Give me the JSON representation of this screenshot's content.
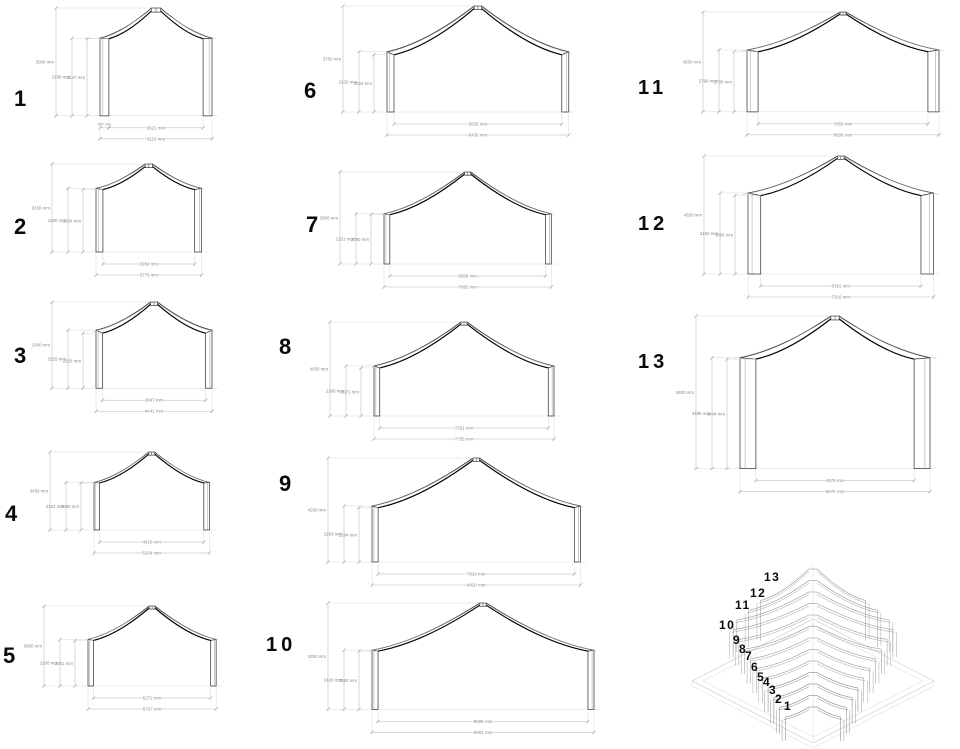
{
  "frames": [
    {
      "number": "1",
      "total_height_label": "3000 mm",
      "eave_height_outer_label": "2158 mm",
      "eave_height_inner_label": "2147 mm",
      "column_width_label": "247 mm",
      "inner_width_label": "2621 mm",
      "outer_width_label": "3116 mm",
      "dims_mm": {
        "total_height": 3000,
        "eave_outer": 2158,
        "eave_inner": 2147,
        "inner_width": 2621,
        "outer_width": 3116
      }
    },
    {
      "number": "2",
      "total_height_label": "3150 mm",
      "eave_height_outer_label": "2280 mm",
      "eave_height_inner_label": "2234 mm",
      "inner_width_label": "3284 mm",
      "outer_width_label": "3779 mm",
      "dims_mm": {
        "total_height": 3150,
        "eave_outer": 2280,
        "eave_inner": 2234,
        "inner_width": 3284,
        "outer_width": 3779
      }
    },
    {
      "number": "3",
      "total_height_label": "3300 mm",
      "eave_height_outer_label": "2225 mm",
      "eave_height_inner_label": "2105 mm",
      "inner_width_label": "3947 mm",
      "outer_width_label": "4441 mm",
      "dims_mm": {
        "total_height": 3300,
        "eave_outer": 2225,
        "eave_inner": 2105,
        "inner_width": 3947,
        "outer_width": 4441
      }
    },
    {
      "number": "4",
      "total_height_label": "3450 mm",
      "eave_height_outer_label": "2104 mm",
      "eave_height_inner_label": "2080 mm",
      "inner_width_label": "4610 mm",
      "outer_width_label": "5104 mm",
      "dims_mm": {
        "total_height": 3450,
        "eave_outer": 2104,
        "eave_inner": 2080,
        "inner_width": 4610,
        "outer_width": 5104
      }
    },
    {
      "number": "5",
      "total_height_label": "3600 mm",
      "eave_height_outer_label": "2100 mm",
      "eave_height_inner_label": "2051 mm",
      "inner_width_label": "5272 mm",
      "outer_width_label": "5767 mm",
      "dims_mm": {
        "total_height": 3600,
        "eave_outer": 2100,
        "eave_inner": 2051,
        "inner_width": 5272,
        "outer_width": 5767
      }
    },
    {
      "number": "6",
      "total_height_label": "3750 mm",
      "eave_height_outer_label": "2132 mm",
      "eave_height_inner_label": "2024 mm",
      "inner_width_label": "5935 mm",
      "outer_width_label": "6430 mm",
      "dims_mm": {
        "total_height": 3750,
        "eave_outer": 2132,
        "eave_inner": 2024,
        "inner_width": 5935,
        "outer_width": 6430
      }
    },
    {
      "number": "7",
      "total_height_label": "3900 mm",
      "eave_height_outer_label": "2131 mm",
      "eave_height_inner_label": "2090 mm",
      "inner_width_label": "6598 mm",
      "outer_width_label": "7092 mm",
      "dims_mm": {
        "total_height": 3900,
        "eave_outer": 2131,
        "eave_inner": 2090,
        "inner_width": 6598,
        "outer_width": 7092
      }
    },
    {
      "number": "8",
      "total_height_label": "4050 mm",
      "eave_height_outer_label": "2160 mm",
      "eave_height_inner_label": "2071 mm",
      "inner_width_label": "7261 mm",
      "outer_width_label": "7755 mm",
      "dims_mm": {
        "total_height": 4050,
        "eave_outer": 2160,
        "eave_inner": 2071,
        "inner_width": 7261,
        "outer_width": 7755
      }
    },
    {
      "number": "9",
      "total_height_label": "4200 mm",
      "eave_height_outer_label": "2263 mm",
      "eave_height_inner_label": "2194 mm",
      "inner_width_label": "7924 mm",
      "outer_width_label": "8420 mm",
      "dims_mm": {
        "total_height": 4200,
        "eave_outer": 2263,
        "eave_inner": 2194,
        "inner_width": 7924,
        "outer_width": 8420
      }
    },
    {
      "number": "10",
      "total_height_label": "4350 mm",
      "eave_height_outer_label": "2420 mm",
      "eave_height_inner_label": "2382 mm",
      "inner_width_label": "8586 mm",
      "outer_width_label": "9081 mm",
      "dims_mm": {
        "total_height": 4350,
        "eave_outer": 2420,
        "eave_inner": 2382,
        "inner_width": 8586,
        "outer_width": 9081
      }
    },
    {
      "number": "11",
      "total_height_label": "4500 mm",
      "eave_height_outer_label": "2790 mm",
      "eave_height_inner_label": "2708 mm",
      "inner_width_label": "7656 mm",
      "outer_width_label": "8656 mm",
      "dims_mm": {
        "total_height": 4500,
        "eave_outer": 2790,
        "eave_inner": 2708,
        "inner_width": 7656,
        "outer_width": 8656
      }
    },
    {
      "number": "12",
      "total_height_label": "4650 mm",
      "eave_height_outer_label": "3192 mm",
      "eave_height_inner_label": "3090 mm",
      "inner_width_label": "6316 mm",
      "outer_width_label": "7316 mm",
      "dims_mm": {
        "total_height": 4650,
        "eave_outer": 3192,
        "eave_inner": 3090,
        "inner_width": 6316,
        "outer_width": 7316
      }
    },
    {
      "number": "13",
      "total_height_label": "4800 mm",
      "eave_height_outer_label": "3485 mm",
      "eave_height_inner_label": "3444 mm",
      "inner_width_label": "4976 mm",
      "outer_width_label": "5976 mm",
      "dims_mm": {
        "total_height": 4800,
        "eave_outer": 3485,
        "eave_inner": 3444,
        "inner_width": 4976,
        "outer_width": 5976
      }
    }
  ],
  "isometric": {
    "frame_labels": [
      "13",
      "12",
      "11",
      "10",
      "9",
      "8",
      "7",
      "6",
      "5",
      "4",
      "3",
      "2",
      "1"
    ]
  }
}
